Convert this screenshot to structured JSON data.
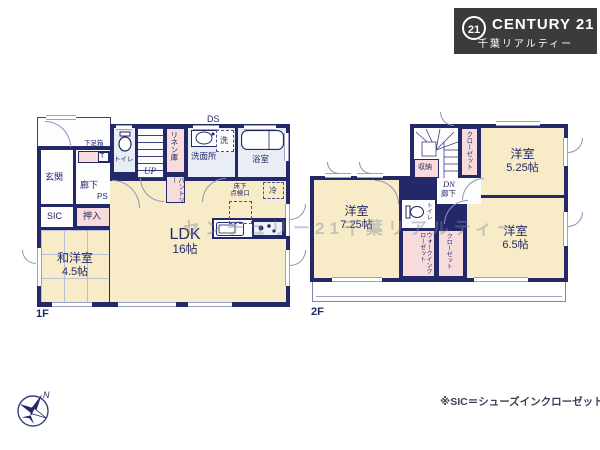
{
  "logo": {
    "mark": "21",
    "brand": "CENTURY 21",
    "sub": "千葉リアルティー"
  },
  "note": "※SIC＝シューズインクローゼット",
  "watermark": "センチュリー21千葉リアルティー",
  "compass": {
    "north": "N"
  },
  "floor1": {
    "label": "1F",
    "rooms": {
      "genkan": "玄関",
      "rouka": "廊下",
      "getabako": "下足箱",
      "t_box": "T",
      "toilet": "トイレ",
      "up": "UP",
      "linen": "リネン庫",
      "sanitary": "洗面所",
      "washer": "洗",
      "bath": "浴室",
      "ds": "DS",
      "pantry": "パントリー",
      "ps": "PS",
      "hatch_line1": "床下",
      "hatch_line2": "点検口",
      "fridge": "冷",
      "sic": "SIC",
      "oshiire": "押入",
      "washitsu_name": "和洋室",
      "washitsu_size": "4.5帖",
      "ldk_name": "LDK",
      "ldk_size": "16帖"
    }
  },
  "floor2": {
    "label": "2F",
    "rooms": {
      "storage": "収納",
      "dn": "DN",
      "rouka": "廊下",
      "closet_a": "クローゼット",
      "bed1_name": "洋室",
      "bed1_size": "5.25帖",
      "bed2_name": "洋室",
      "bed2_size": "7.25帖",
      "bed3_name": "洋室",
      "bed3_size": "6.5帖",
      "toilet": "トイレ",
      "wic": "ウォークインクローゼット",
      "closet_b": "クローゼット"
    }
  },
  "colors": {
    "wall": "#232968",
    "room": "#f7ebc8",
    "closet": "#f8dcdc",
    "wet": "#e9eef6",
    "logo_bg": "#3b3b3b"
  }
}
